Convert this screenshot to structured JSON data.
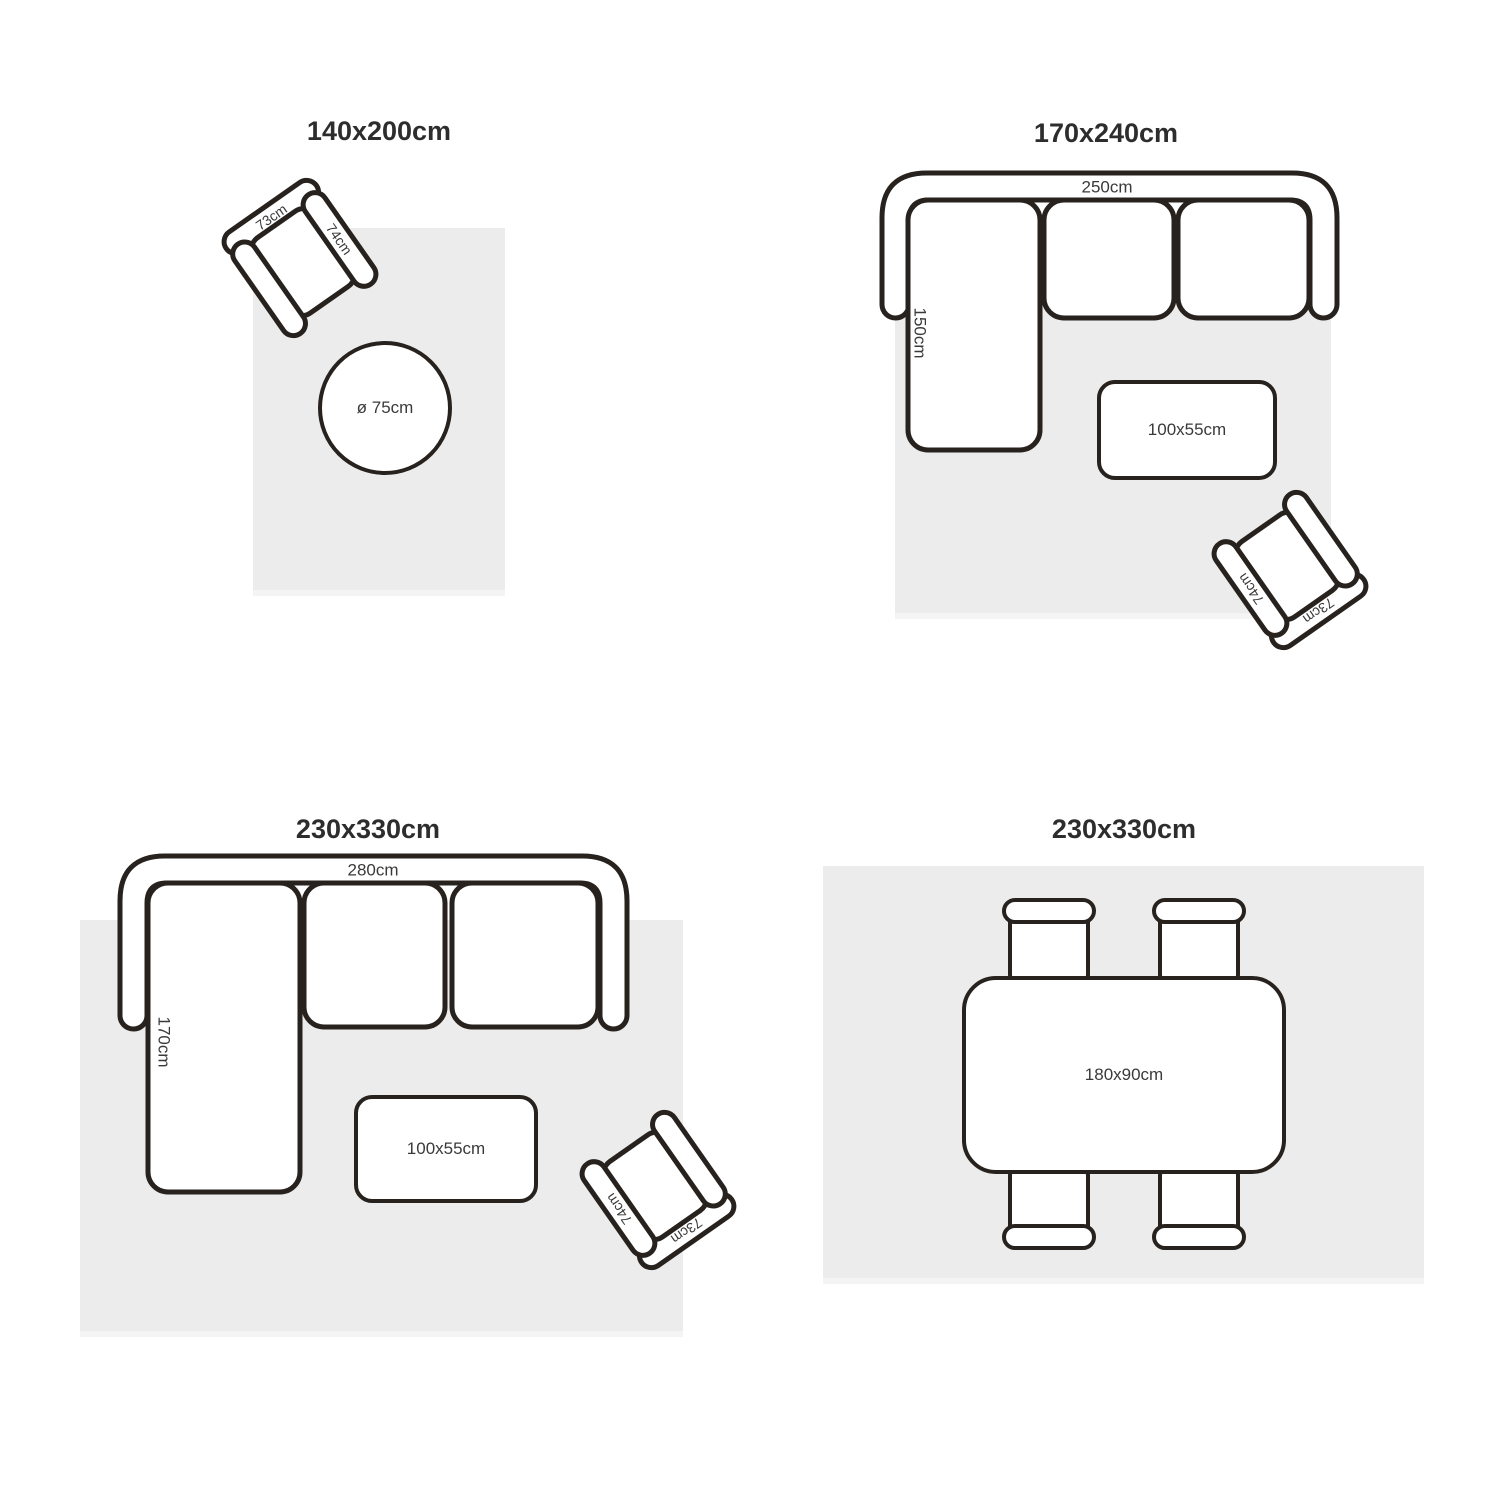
{
  "page": {
    "background": "#ffffff",
    "line_color": "#27221e",
    "rug_color": "#ececec",
    "label_color": "#3a3a3a",
    "title_color": "#2d2d2d"
  },
  "quadrants": {
    "tl": {
      "title": "140x200cm",
      "armchair": {
        "back_label": "73cm",
        "arm_label": "74cm"
      },
      "round_rug": {
        "label": "ø 75cm"
      }
    },
    "tr": {
      "title": "170x240cm",
      "sofa": {
        "width_label": "250cm",
        "depth_label": "150cm"
      },
      "coffee_table": {
        "label": "100x55cm"
      },
      "armchair": {
        "back_label": "73cm",
        "arm_label": "74cm"
      }
    },
    "bl": {
      "title": "230x330cm",
      "sofa": {
        "width_label": "280cm",
        "depth_label": "170cm"
      },
      "coffee_table": {
        "label": "100x55cm"
      },
      "armchair": {
        "back_label": "73cm",
        "arm_label": "74cm"
      }
    },
    "br": {
      "title": "230x330cm",
      "dining_table": {
        "label": "180x90cm"
      },
      "chair_count": "4"
    }
  }
}
